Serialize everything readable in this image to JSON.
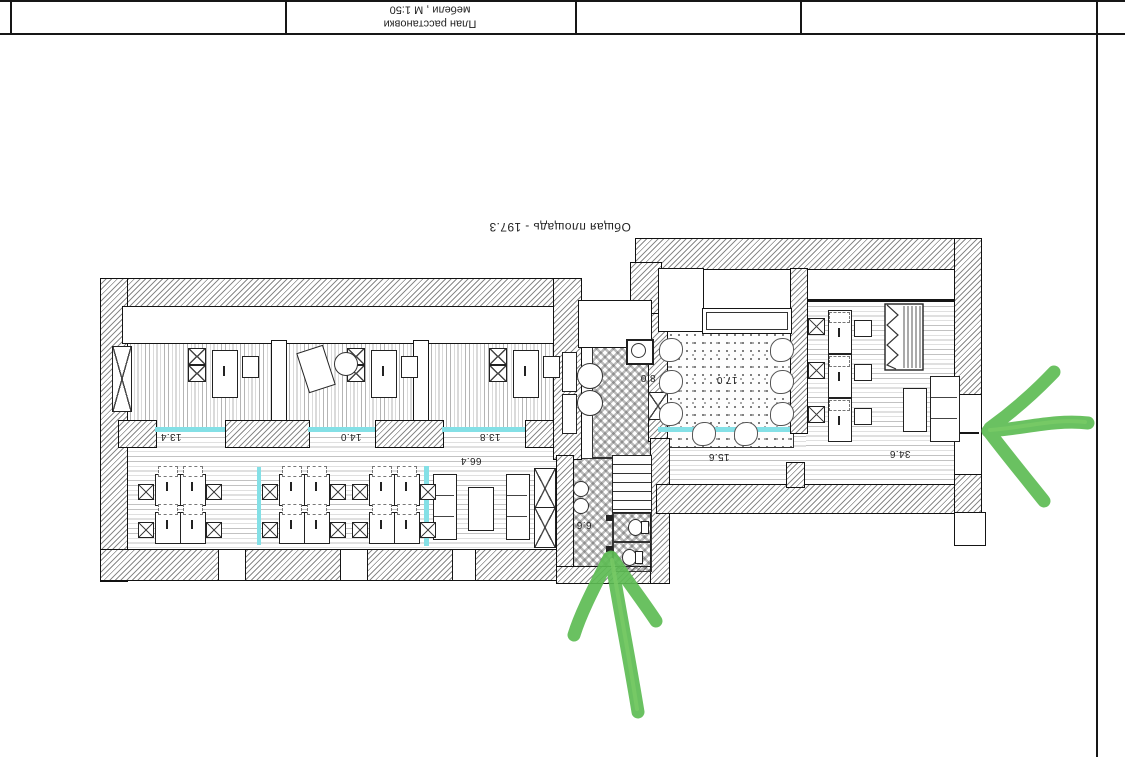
{
  "title_block": {
    "title_line1": "План расстановки",
    "title_line2": "мебели , М 1:50"
  },
  "plan": {
    "total_area_label": "Общая площадь - 197.3",
    "rooms": [
      {
        "id": "office-1",
        "area": "13.4"
      },
      {
        "id": "office-2",
        "area": "14.0"
      },
      {
        "id": "office-3",
        "area": "13.8"
      },
      {
        "id": "kitchen",
        "area": "8.0"
      },
      {
        "id": "soft-room",
        "area": "17.0"
      },
      {
        "id": "open-space",
        "area": "66.4"
      },
      {
        "id": "hall",
        "area": "15.6"
      },
      {
        "id": "office-4",
        "area": "34.6"
      },
      {
        "id": "wc-block",
        "area": "6.6"
      }
    ]
  },
  "annotations": {
    "arrows": [
      "entrance-arrow-right",
      "entrance-arrow-bottom"
    ],
    "marker_color": "#5ebc54"
  },
  "colors": {
    "glass_partition": "#84e0e6",
    "line": "#161616"
  }
}
